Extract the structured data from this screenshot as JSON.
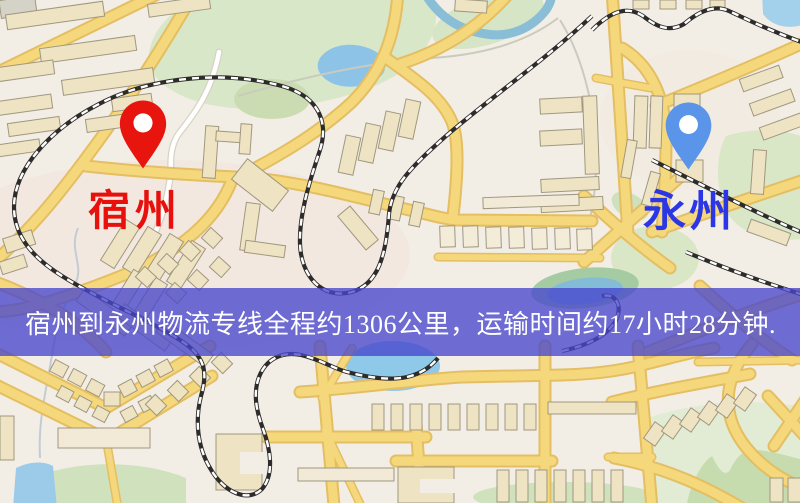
{
  "banner": {
    "text": "宿州到永州物流专线全程约1306公里，运输时间约17小时28分钟.",
    "distance": "1306公里",
    "duration": "17小时28分钟",
    "background_color": "#4846cd",
    "text_color": "#ffffff"
  },
  "origin": {
    "label": "宿州",
    "pin_icon": "map-pin",
    "pin_color": "#e8140e",
    "label_color": "#e8100c"
  },
  "destination": {
    "label": "永州",
    "pin_icon": "map-pin",
    "pin_color": "#5b95ea",
    "label_color": "#2b36e4"
  },
  "map": {
    "background_color": "#f3eee5",
    "road_color": "#f6d87c",
    "railway_color": "#2e2c2a",
    "water_color": "#8ec3e8",
    "park_color": "#d9e7c9"
  }
}
